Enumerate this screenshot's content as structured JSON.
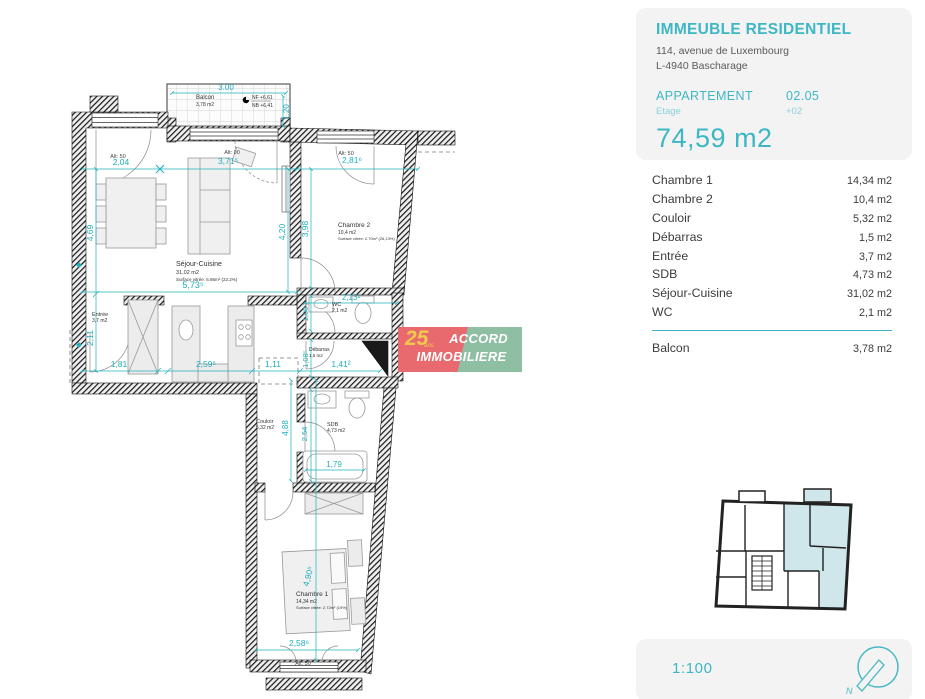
{
  "colors": {
    "accent": "#3db7c3",
    "dimension_teal": "#1db0bc",
    "keyplan_highlight": "#cfe7ea",
    "logo_red": "#e96a6e",
    "logo_green": "#8fbfa2",
    "logo_yellow": "#f2c94c"
  },
  "panel": {
    "title": "IMMEUBLE RESIDENTIEL",
    "address_line1": "114, avenue de Luxembourg",
    "address_line2": "L-4940 Bascharage",
    "apartment_label": "APPARTEMENT",
    "apartment_number": "02.05",
    "floor_label": "Etage",
    "floor_value": "+02",
    "total_area": "74,59 m2",
    "rooms": [
      {
        "label": "Chambre 1",
        "area": "14,34 m2"
      },
      {
        "label": "Chambre 2",
        "area": "10,4 m2"
      },
      {
        "label": "Couloir",
        "area": "5,32 m2"
      },
      {
        "label": "Débarras",
        "area": "1,5 m2"
      },
      {
        "label": "Entrée",
        "area": "3,7 m2"
      },
      {
        "label": "SDB",
        "area": "4,73 m2"
      },
      {
        "label": "Séjour-Cuisine",
        "area": "31,02 m2"
      },
      {
        "label": "WC",
        "area": "2,1 m2"
      }
    ],
    "balcony_row": {
      "label": "Balcon",
      "area": "3,78 m2"
    },
    "scale": "1:100",
    "north_letter": "N"
  },
  "plan": {
    "balcony": {
      "name": "Balcon",
      "area": "3,78 m2"
    },
    "level_marker": {
      "nf": "NF +6,61",
      "nb": "NB +6,41"
    },
    "rooms": {
      "sejour": {
        "name": "Séjour-Cuisine",
        "area": "31,02 m2",
        "note": "Surface vitrée: 6.86m² (22.2%)"
      },
      "chambre2": {
        "name": "Chambre 2",
        "area": "10,4 m2",
        "note": "Surface vitrée: 2.70m² (26,13%)"
      },
      "entree": {
        "name": "Entrée",
        "area": "3,7 m2"
      },
      "wc": {
        "name": "WC",
        "area": "2,1 m2"
      },
      "debarras": {
        "name": "Débarras",
        "area": "1,5 m2"
      },
      "couloir": {
        "name": "Couloir",
        "area": "5,32 m2"
      },
      "sdb": {
        "name": "SDB",
        "area": "4,73 m2"
      },
      "chambre1": {
        "name": "Chambre 1",
        "area": "14,34 m2",
        "note": "Surface vitrée: 2.72m² (19%)"
      }
    },
    "dims": {
      "balcony_w": "3.00",
      "balcony_h": "1,20",
      "top1": "2,04",
      "top2": "3,71⁵",
      "top3": "2,81⁶",
      "left1": "4,69",
      "left2": "2,11",
      "mid_v1": "4,20",
      "mid_v2": "3,98",
      "sejour_w": "5,73⁵",
      "wc_w": "2,13¹",
      "wc_h": "1,00",
      "debarras_h": "1,08⁵",
      "bot1": "1,81",
      "bot2": "2,59⁵",
      "bot3": "1,11",
      "bot4": "1,41²",
      "couloir_h": "4,88",
      "sdb_h": "2,54",
      "tub_w": "1,79",
      "ch1_h": "4,90⁵",
      "ch1_w": "2,58⁶"
    },
    "alt": {
      "a1": "Alt: 50",
      "a2": "Alt: 00",
      "a3": "Alt: 50",
      "a4": "Alt: 50"
    }
  },
  "logo": {
    "years": "25",
    "years_word": "ans",
    "line1": "ACCORD",
    "line2": "IMMOBILIERE"
  }
}
